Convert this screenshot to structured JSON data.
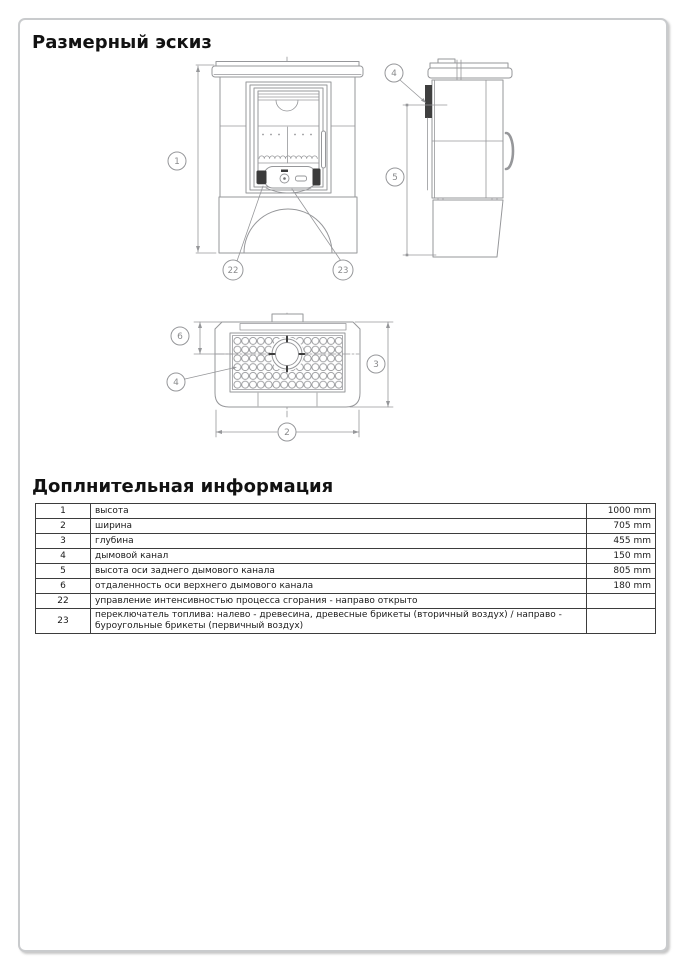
{
  "page": {
    "title": "Размерный эскиз",
    "info_title": "Доплнительная информация"
  },
  "callouts": {
    "front_height": "1",
    "front_control_left": "22",
    "front_control_right": "23",
    "side_flue": "4",
    "side_axis_height": "5",
    "top_offset": "6",
    "top_grille": "4",
    "top_depth": "3",
    "top_width": "2"
  },
  "table": {
    "rows": [
      {
        "num": "1",
        "desc": "высота",
        "value": "1000 mm"
      },
      {
        "num": "2",
        "desc": "ширина",
        "value": "705 mm"
      },
      {
        "num": "3",
        "desc": "глубина",
        "value": "455 mm"
      },
      {
        "num": "4",
        "desc": "дымовой канал",
        "value": "150 mm"
      },
      {
        "num": "5",
        "desc": "высота оси заднего дымового канала",
        "value": "805 mm"
      },
      {
        "num": "6",
        "desc": "отдаленность оси верхнего дымового канала",
        "value": "180 mm"
      },
      {
        "num": "22",
        "desc": "управление интенсивностью процесса сгорания - направо открыто",
        "value": ""
      },
      {
        "num": "23",
        "desc": "переключатель топлива: налево - древесина, древесные брикеты (вторичный воздух) / направо - буроугольные брикеты (первичный воздух)",
        "value": ""
      }
    ]
  }
}
